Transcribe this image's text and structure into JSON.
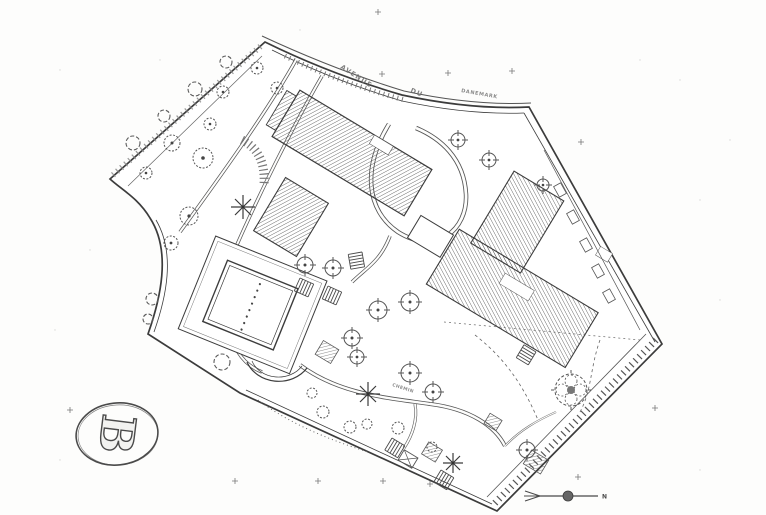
{
  "plan": {
    "kind": "scanned architectural site plan",
    "street_words": [
      "AVENUE",
      "DU",
      "DANEMARK"
    ],
    "path_label": "CHEMIN",
    "sheet_label": "B",
    "north_label": "N",
    "ink_color": "#3c3c3c",
    "hatch_color": "#4d4d4d",
    "paper_color": "#fdfdfc",
    "symbols": {
      "tree": "dashed-circle-with-center-dot",
      "shrub-clump": "scalloped-circle",
      "planter": "circle-with-cross-ticks-and-dot",
      "palm": "eight-spoke-star-burst",
      "fountain": "dashed-flower-circle",
      "survey-mark": "small-plus-cross",
      "stairs": "ladder-rungs",
      "north_arrow": "line-with-filled-circle-and-fishtail"
    }
  }
}
